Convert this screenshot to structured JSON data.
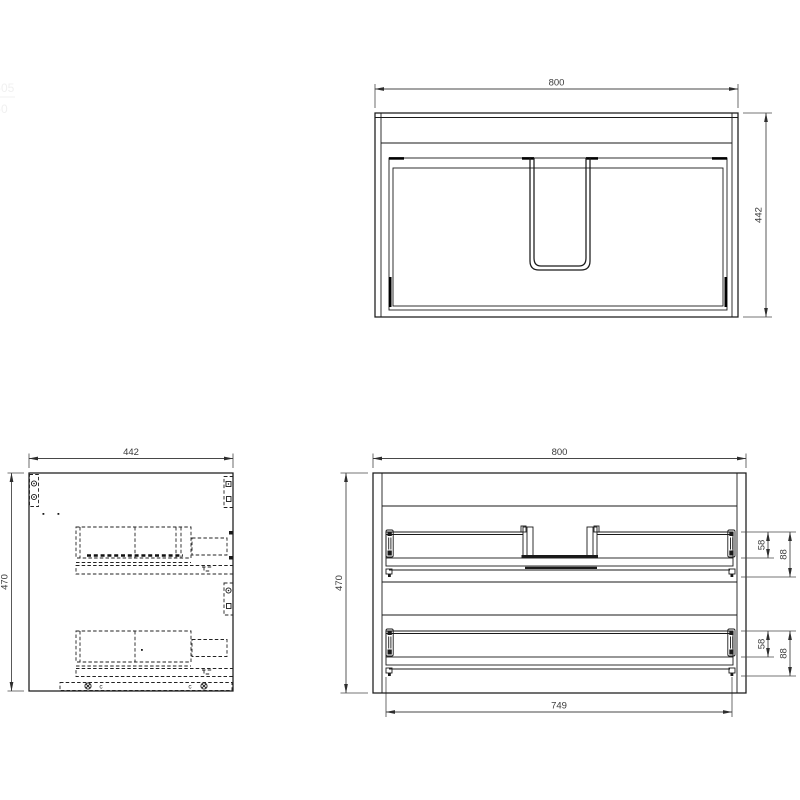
{
  "page": {
    "background_color": "#ffffff",
    "line_color": "#1a1a1a",
    "dimension_color": "#3a3a3a"
  },
  "edge_fragments": {
    "top": "-05",
    "bottom": "-0"
  },
  "plan_view": {
    "width_dim": "800",
    "depth_dim": "442"
  },
  "side_view": {
    "width_dim": "442",
    "height_dim": "470",
    "bottom_marker_left": "c",
    "bottom_marker_right": "c"
  },
  "back_view": {
    "width_dim": "800",
    "height_dim": "470",
    "inner_width_dim": "749",
    "upper_drawer": {
      "back_height_dim": "58",
      "assembly_height_dim": "88"
    },
    "lower_drawer": {
      "back_height_dim": "58",
      "assembly_height_dim": "88"
    }
  }
}
